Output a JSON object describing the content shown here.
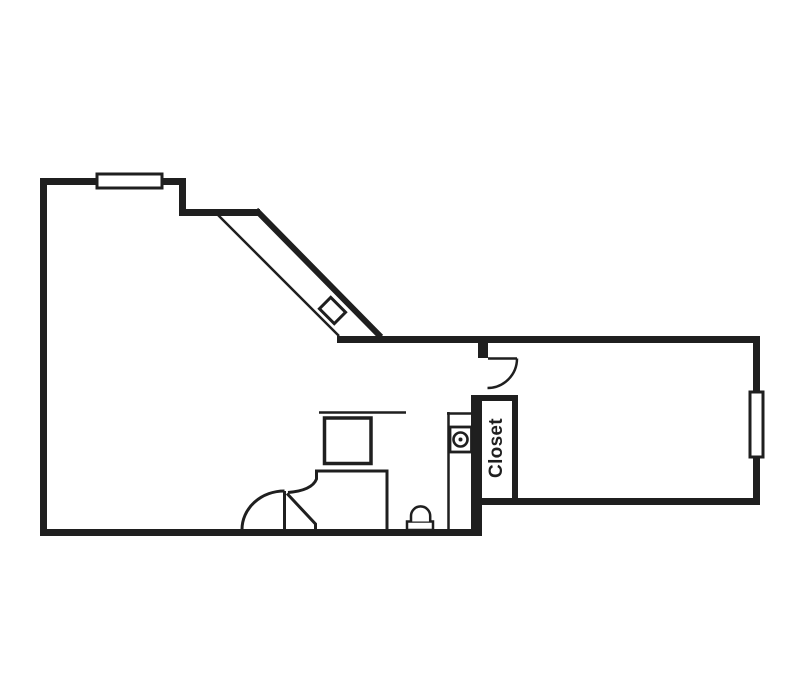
{
  "colors": {
    "wall": "#1f1f1f",
    "background": "#ffffff",
    "window_fill": "#ffffff"
  },
  "plan": {
    "closet_label": "Closet",
    "fixture_names": [
      "top-window",
      "sloped-wall-window",
      "right-window",
      "entry-door-swing",
      "closet",
      "sink",
      "toilet",
      "shower-stall",
      "curved-shower-door"
    ]
  }
}
